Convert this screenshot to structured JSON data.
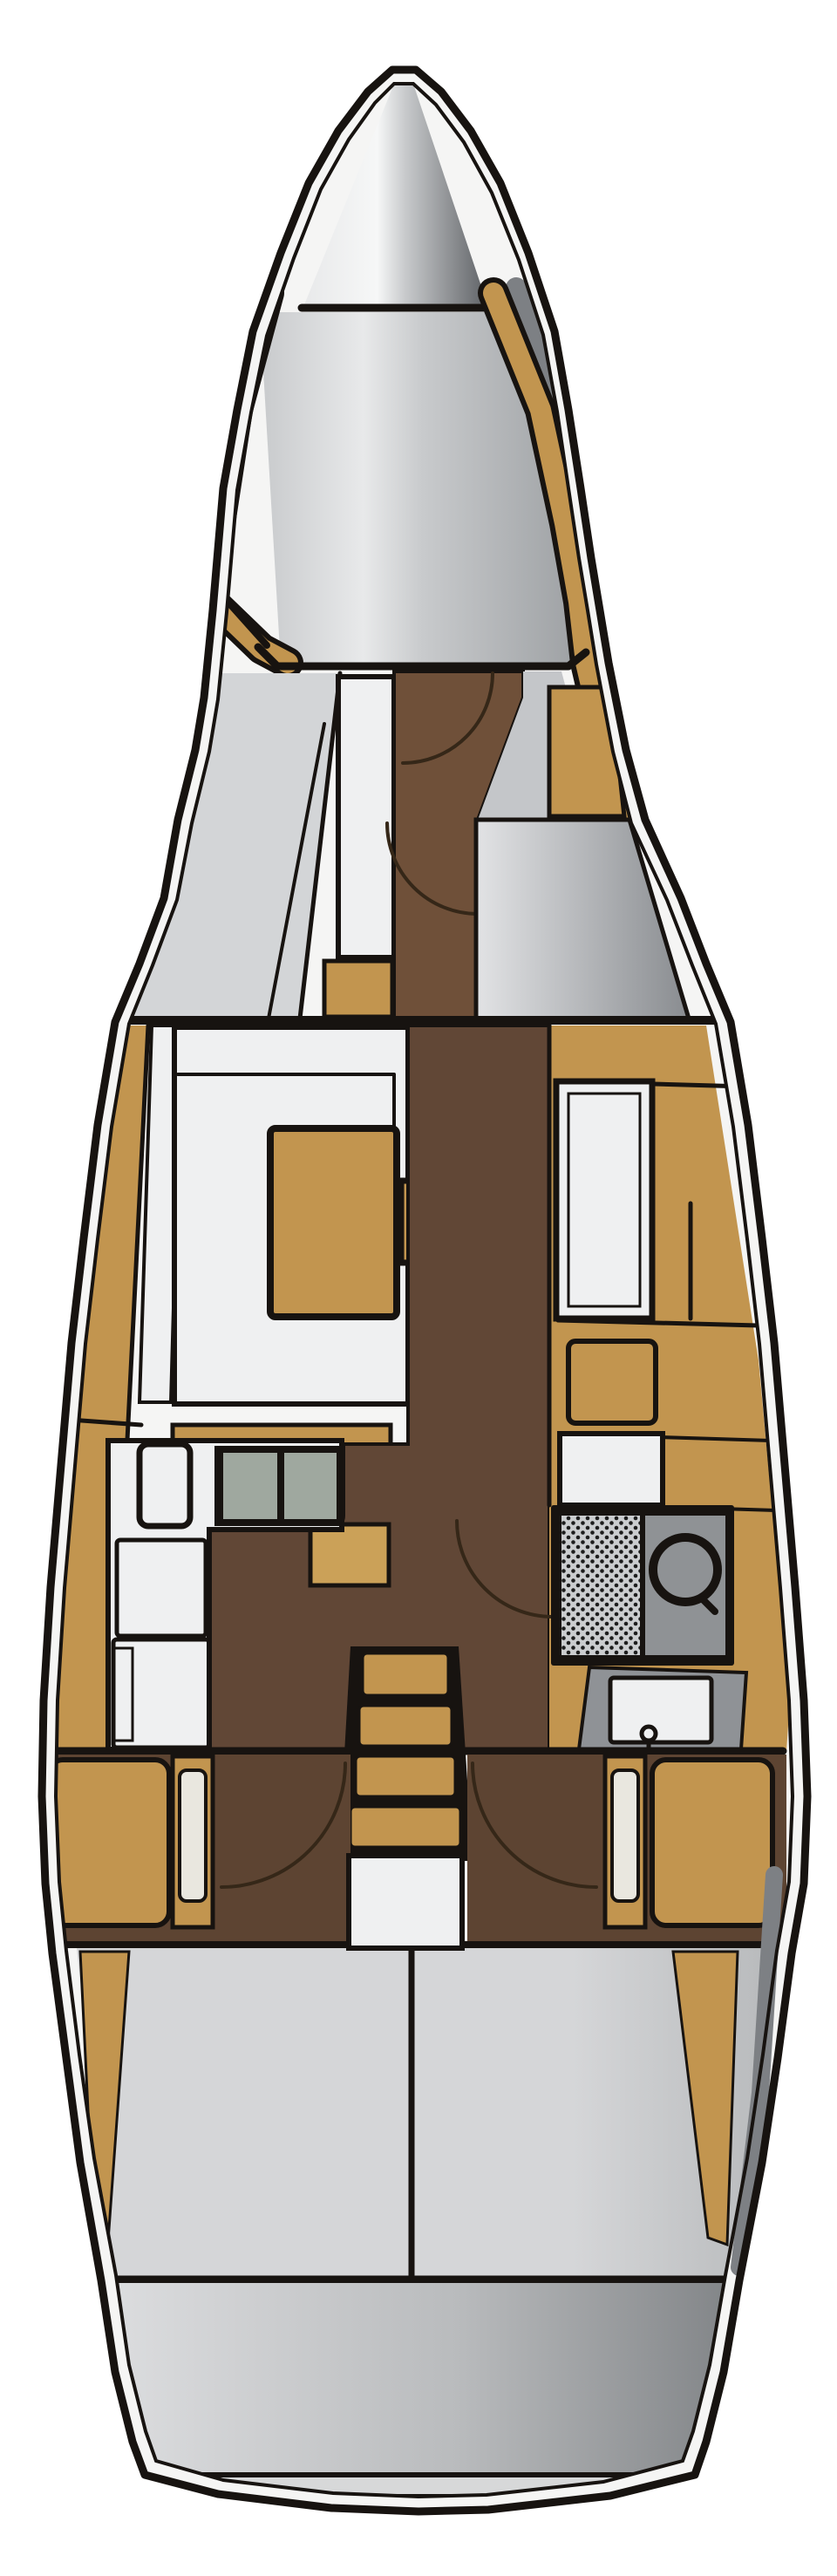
{
  "diagram": {
    "type": "yacht-interior-floorplan",
    "view": "top-down",
    "subject": "sailboat hull with interior cabin layout, bow at top, stern at bottom"
  },
  "colors": {
    "pageBg": "#ffffff",
    "outline": "#171310",
    "rim": "#f5f5f4",
    "shadow": "#7d8084",
    "teak": "#c2954f",
    "teakLight": "#cba158",
    "brownFwd": "#6f5039",
    "brownMid": "#614736",
    "brownAft": "#5d4432",
    "berthGray": "#d3d5d7",
    "wedgeGray": "#c4c6c9",
    "white": "#eff0f1",
    "cream": "#e9e7df",
    "sinkBasin": "#9fa89f",
    "stovePanel": "#cbcdcf",
    "stoveRight": "#8f9295",
    "stoveDot": "#1d1d1d",
    "engineGray": "#8f9296",
    "anchorLight": "#f6f7f7",
    "anchorDark": "#5e6165",
    "deckLight": "#e8e9ea",
    "deckMid": "#c8cacc",
    "deckDark": "#9fa2a5",
    "headsLight": "#e2e3e5",
    "headsDark": "#898c90",
    "cockpitLight": "#d5d6d8",
    "cockpitDark": "#b9bbbd",
    "transomLight": "#dcdddf",
    "transomDark": "#7f8285",
    "platform": "#d7d8d9",
    "arcLine": "#352718"
  },
  "icons": [
    "keyhole-icon",
    "sink-circle-icon",
    "door-arc-icon",
    "stove-hatch-icon"
  ],
  "regions": [
    {
      "id": "anchor-locker",
      "fill": "anchor gradient"
    },
    {
      "id": "foredeck",
      "fill": "deck gradient"
    },
    {
      "id": "v-berth",
      "fill": "berthGray"
    },
    {
      "id": "forward-cabin-floor",
      "fill": "brownFwd"
    },
    {
      "id": "wardrobe",
      "fill": "teak"
    },
    {
      "id": "heads-compartment",
      "fill": "heads gradient"
    },
    {
      "id": "settee",
      "fill": "white"
    },
    {
      "id": "salon-table",
      "fill": "teak"
    },
    {
      "id": "galley-counter",
      "fill": "white"
    },
    {
      "id": "galley-sink",
      "fill": "sinkBasin"
    },
    {
      "id": "stove-unit",
      "fill": "stovePanel"
    },
    {
      "id": "nav-station",
      "fill": "white"
    },
    {
      "id": "engine-compartment",
      "fill": "engineGray"
    },
    {
      "id": "companionway-steps",
      "fill": "teak"
    },
    {
      "id": "aft-cabin-port-berth",
      "fill": "teak"
    },
    {
      "id": "aft-cabin-starboard-berth",
      "fill": "teak"
    },
    {
      "id": "cockpit",
      "fill": "cockpit gradient"
    },
    {
      "id": "transom",
      "fill": "transom gradient"
    },
    {
      "id": "swim-platform",
      "fill": "platform"
    }
  ]
}
